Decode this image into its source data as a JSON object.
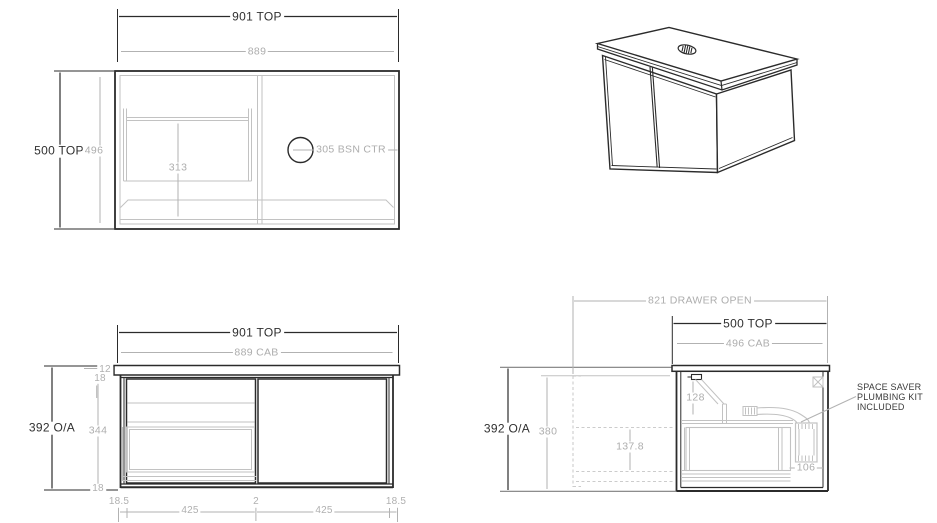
{
  "colors": {
    "line_black": "#2b2b2b",
    "line_gray": "#b2b2b2",
    "hidden_gray": "#c2c2c2",
    "text_black": "#303030",
    "text_gray": "#adadad",
    "background": "#ffffff"
  },
  "views": {
    "plan": {
      "dims": {
        "width_top": "901 TOP",
        "width_cab": "889",
        "depth_top": "500 TOP",
        "depth_cab": "496",
        "drawer_internal": "313",
        "basin_centre": "305 BSN CTR"
      }
    },
    "front": {
      "dims": {
        "width_top": "901 TOP",
        "width_cab": "889 CAB",
        "height_overall": "392 O/A",
        "height_internal": "344",
        "top_thickness": "12",
        "top_reveal": "18",
        "bottom_reveal": "18",
        "left_margin": "18.5",
        "door_left": "425",
        "centre_gap": "2",
        "door_right": "425",
        "right_margin": "18.5"
      }
    },
    "side": {
      "dims": {
        "drawer_open": "821 DRAWER OPEN",
        "depth_top": "500 TOP",
        "depth_cab": "496 CAB",
        "height_overall": "392 O/A",
        "height_cab": "380",
        "waste_drop": "128",
        "drawer_travel": "137.8",
        "trap_width": "106"
      },
      "note_lines": [
        "SPACE SAVER",
        "PLUMBING KIT",
        "INCLUDED"
      ]
    }
  }
}
